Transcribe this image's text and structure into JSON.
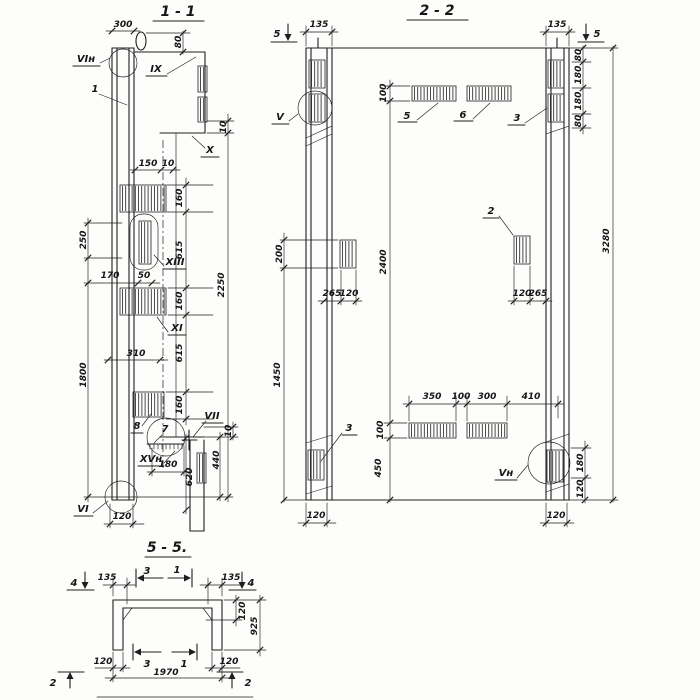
{
  "s11": {
    "title": "1 - 1",
    "marks": {
      "loop": "VIн",
      "pos1": "1",
      "ix": "IX",
      "x": "X",
      "xiii": "XIII",
      "xi": "XI",
      "pos8": "8",
      "pos7": "7",
      "vii": "VII",
      "xvn": "XVн",
      "vi": "VI"
    },
    "dims": {
      "w300": "300",
      "h80": "80",
      "h10a": "10",
      "w150": "150",
      "w10": "10",
      "h160a": "160",
      "h615a": "615",
      "h160b": "160",
      "h615b": "615",
      "h160c": "160",
      "h2250": "2250",
      "h250": "250",
      "w170": "170",
      "w50": "50",
      "w310": "310",
      "h1800": "1800",
      "w180": "180",
      "h620": "620",
      "h440": "440",
      "h10b": "10",
      "w120": "120"
    }
  },
  "s22": {
    "title": "2 - 2",
    "marks": {
      "cut5l": "5",
      "cut5r": "5",
      "v": "V",
      "pos3r": "3",
      "pos5": "5",
      "pos6": "6",
      "pos2": "2",
      "pos3l": "3",
      "vn": "Vн"
    },
    "dims": {
      "w135l": "135",
      "w135r": "135",
      "h80a": "80",
      "h180a": "180",
      "h180b": "180",
      "h80b": "80",
      "h100t": "100",
      "h3280": "3280",
      "h200": "200",
      "w265l": "265",
      "w120l": "120",
      "h2400": "2400",
      "w120r": "120",
      "w265r": "265",
      "w350": "350",
      "w100": "100",
      "w300": "300",
      "w410": "410",
      "h100b": "100",
      "h450": "450",
      "h1450": "1450",
      "h180r": "180",
      "h120r": "120",
      "w120cl": "120",
      "w120cr": "120"
    }
  },
  "s55": {
    "title": "5 - 5.",
    "marks": {
      "cut4l": "4",
      "cut4r": "4",
      "cut3t": "3",
      "cut1t": "1",
      "cut3b": "3",
      "cut1b": "1",
      "cut2l": "2",
      "cut2r": "2"
    },
    "dims": {
      "w135l": "135",
      "w135r": "135",
      "h120": "120",
      "h925": "925",
      "w120l": "120",
      "w120r": "120",
      "w1970": "1970"
    }
  }
}
